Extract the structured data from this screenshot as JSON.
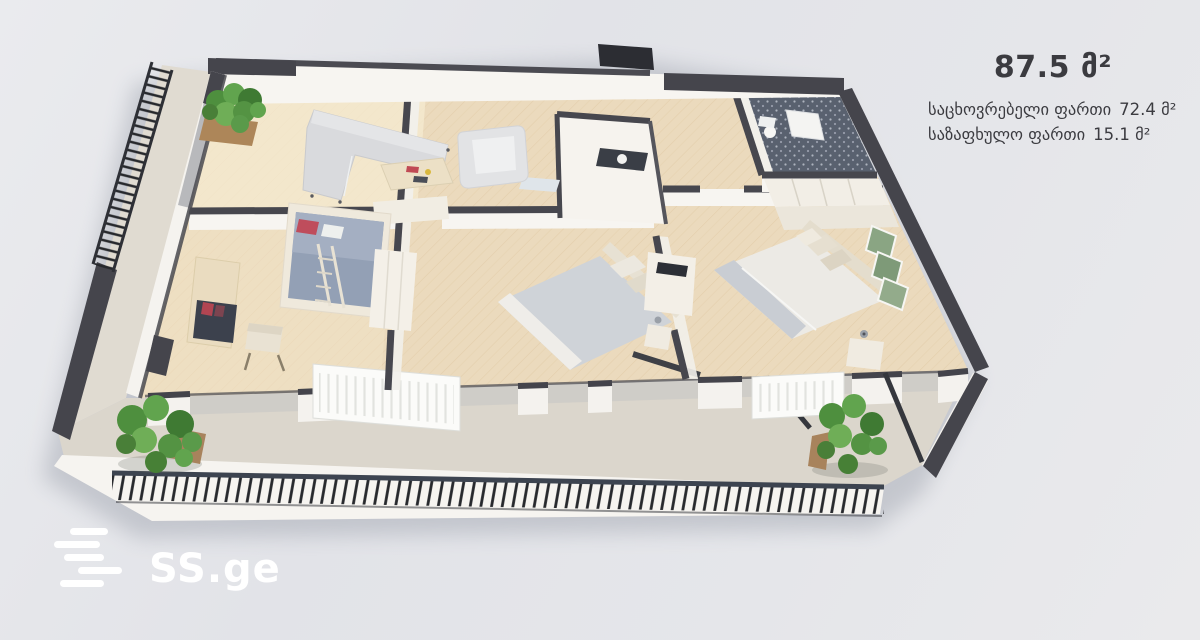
{
  "window": {
    "width": 1200,
    "height": 640,
    "description": "3D isometric apartment floor plan render on a real-estate listing image"
  },
  "overlay": {
    "total_area": "87.5 მ²",
    "areas": [
      {
        "label": "საცხოვრებელი ფართი",
        "value": "72.4 მ²"
      },
      {
        "label": "საზაფხულო ფართი",
        "value": "15.1 მ²"
      }
    ]
  },
  "logo": {
    "text": "SS.ge"
  },
  "floorplan": {
    "type": "3d-floor-plan",
    "rooms": [
      "living-room",
      "kids-room",
      "bedroom-center",
      "bedroom-right",
      "bathroom",
      "hallway",
      "wc",
      "front-balcony",
      "side-balcony"
    ],
    "features": [
      "l-shaped-sofa",
      "armchair",
      "coffee-table",
      "bunk-bed",
      "desk-with-shelf",
      "double-bed",
      "double-bed",
      "wardrobes",
      "radiators",
      "slatted-railing",
      "green-plants"
    ]
  },
  "colors": {
    "background": "#e6e7eb",
    "text": "#3b3b40",
    "logo": "#ffffff",
    "wall_dark": "#45454c",
    "wall_white": "#f6f4f1",
    "floor_wood": "#ebdabd",
    "balcony_floor": "#dbd6cc",
    "bathroom_tile": "#59616f",
    "plant_green": "#5a9a4a",
    "railing": "#2e3036"
  }
}
